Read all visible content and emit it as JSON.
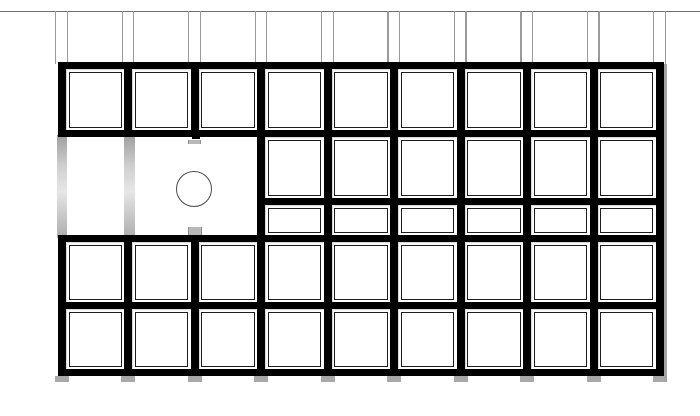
{
  "diagram": {
    "type": "panel-grid-elevation",
    "canvas": {
      "width": 700,
      "height": 416,
      "background": "#ffffff"
    },
    "colors": {
      "frame_black": "#000000",
      "inner_frame": "#1c1c1c",
      "ceiling_line": "#6e6e6e",
      "hanger_line": "#9a9a9a",
      "ghost_bar_top": "#9e9e9e",
      "ghost_bar_mid": "#e6e6e6",
      "ghost_bar_bottom": "#adadad",
      "foot_gray": "#a8a8a8",
      "shadow_gray": "#a3a3a3",
      "circle_stroke": "#4a4a4a",
      "tick_gray": "#b8b8b8",
      "cell_white": "#ffffff"
    },
    "ceiling_line": {
      "y": 10.5,
      "thickness": 1.4
    },
    "hangers": {
      "y_top": 11,
      "y_bottom": 64,
      "offset_left": -6.8,
      "offset_right": 4.7,
      "line_width": 1.3
    },
    "grid": {
      "column_boundaries_x": [
        62,
        128.4,
        194.9,
        261.3,
        327.8,
        394.2,
        460.7,
        527.1,
        593.6,
        660
      ],
      "v_border": 8,
      "h_border": 7,
      "cell_inner_inset": 2.5,
      "rows": [
        {
          "name": "row-1",
          "top": 65.5,
          "bottom": 133.5,
          "col_start": 0,
          "col_end": 9
        },
        {
          "name": "row-2-upper",
          "top": 133.5,
          "bottom": 201.5,
          "col_start": 3,
          "col_end": 9
        },
        {
          "name": "row-2-lower",
          "top": 201.5,
          "bottom": 238.5,
          "col_start": 3,
          "col_end": 9
        },
        {
          "name": "row-3",
          "top": 238.5,
          "bottom": 305.5,
          "col_start": 0,
          "col_end": 9
        },
        {
          "name": "row-4",
          "top": 305.5,
          "bottom": 372.5,
          "col_start": 0,
          "col_end": 9
        }
      ]
    },
    "open_bay": {
      "ghost_bars": [
        {
          "x": 57,
          "width": 10,
          "top": 135,
          "bottom": 238
        },
        {
          "x": 124,
          "width": 11,
          "top": 135,
          "bottom": 238
        }
      ],
      "circle": {
        "cx": 193.5,
        "cy": 189,
        "r": 18,
        "stroke_width": 1.6
      },
      "stub": {
        "x": 191.5,
        "y": 135,
        "width": 8,
        "height": 4
      },
      "ticks": [
        {
          "x": 187.5,
          "y": 139.5,
          "width": 13,
          "height": 4.5
        },
        {
          "x": 187.5,
          "y": 226.5,
          "width": 14,
          "height": 8.5
        }
      ]
    },
    "feet": {
      "y": 376,
      "width": 14,
      "height": 6
    },
    "right_shadow": {
      "x": 663.5,
      "y": 64,
      "width": 3.5,
      "height": 317
    }
  }
}
